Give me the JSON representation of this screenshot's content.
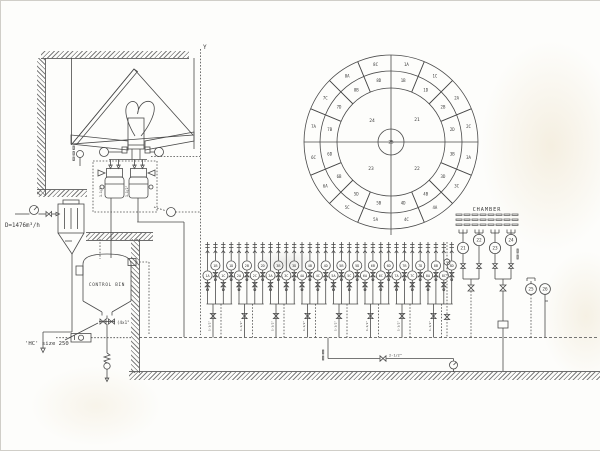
{
  "drawing": {
    "corner_mark": "Y",
    "control_bin_label": "CONTROL BIN",
    "annotations": {
      "flow_rate": "D=1476m³/h",
      "hc_size": "'HC' size 250",
      "outlet_valves": "(4x1\"",
      "pipe_size_small": "1-1/2\"",
      "pipe_size_main": "2-1/2\""
    }
  },
  "chamber_diagram": {
    "center": "25",
    "quadrants": [
      {
        "label": "24",
        "pos": "top-left"
      },
      {
        "label": "21",
        "pos": "top-right"
      },
      {
        "label": "22",
        "pos": "bottom-right"
      },
      {
        "label": "23",
        "pos": "bottom-left"
      }
    ],
    "sectors": [
      {
        "id": "1",
        "cells": [
          "1A",
          "1B",
          "1C",
          "1D"
        ]
      },
      {
        "id": "2",
        "cells": [
          "2A",
          "2B",
          "2C",
          "2D"
        ]
      },
      {
        "id": "3",
        "cells": [
          "3A",
          "3B",
          "3C",
          "3D"
        ]
      },
      {
        "id": "4",
        "cells": [
          "4A",
          "4B",
          "4C",
          "4D"
        ]
      },
      {
        "id": "5",
        "cells": [
          "5A",
          "5B",
          "5C",
          "5D"
        ]
      },
      {
        "id": "6",
        "cells": [
          "6A",
          "6B",
          "6C",
          "6D"
        ]
      },
      {
        "id": "7",
        "cells": [
          "7A",
          "7B",
          "7C",
          "7D"
        ]
      },
      {
        "id": "8",
        "cells": [
          "8A",
          "8B",
          "8C",
          "8D"
        ]
      }
    ]
  },
  "manifold": {
    "clusters": [
      {
        "sector": "1",
        "cells": [
          "1A",
          "1B",
          "1C",
          "1D"
        ]
      },
      {
        "sector": "2",
        "cells": [
          "2A",
          "2B",
          "2C",
          "2D"
        ]
      },
      {
        "sector": "3",
        "cells": [
          "3A",
          "3B",
          "3C",
          "3D"
        ]
      },
      {
        "sector": "4",
        "cells": [
          "4A",
          "4B",
          "4C",
          "4D"
        ]
      },
      {
        "sector": "5",
        "cells": [
          "5A",
          "5B",
          "5C",
          "5D"
        ]
      },
      {
        "sector": "6",
        "cells": [
          "6A",
          "6B",
          "6C",
          "6D"
        ]
      },
      {
        "sector": "7",
        "cells": [
          "7A",
          "7B",
          "7C",
          "7D"
        ]
      },
      {
        "sector": "8",
        "cells": [
          "8A",
          "8B",
          "8C",
          "8D"
        ]
      }
    ]
  },
  "chamber_feed": {
    "label": "CHAMBER",
    "quadrant_valves": [
      "21",
      "22",
      "23",
      "24"
    ],
    "instruments": [
      "25",
      "26"
    ]
  }
}
